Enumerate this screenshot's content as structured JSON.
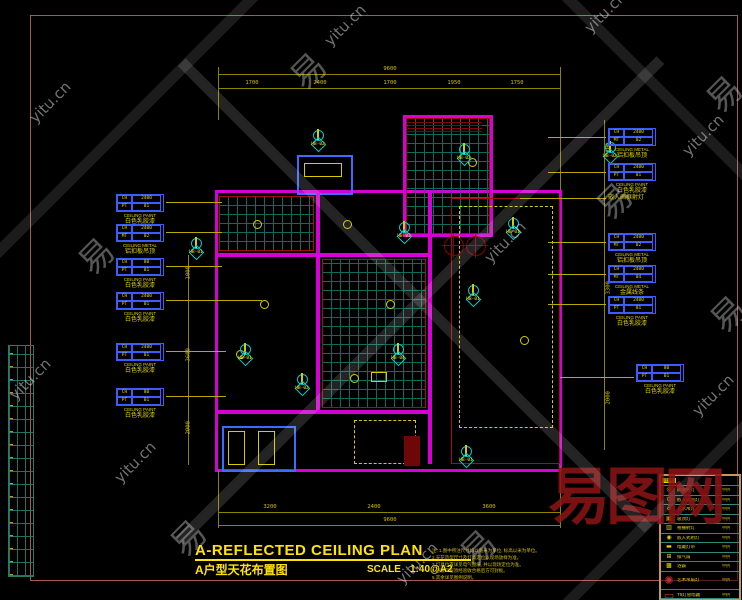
{
  "colors": {
    "yellow": "#d8cc00",
    "magenta": "#d400d4",
    "cyan": "#00cccc",
    "teal_grid": "#107060",
    "red": "#a01010",
    "frame": "#a85858",
    "blue": "#3c6cff",
    "logo_red": "#8a1416"
  },
  "watermarks": {
    "site": "yitu.cn",
    "char": "易",
    "logo": "易图网"
  },
  "titlebar": {
    "title_en": "A-REFLECTED CEILING PLAN",
    "title_cn": "A户型天花布置图",
    "scale_label": "SCALE",
    "scale_value": "1:40@A2"
  },
  "notes": {
    "heading": "注:",
    "lines": [
      "1.图中所注尺寸均以毫米为单位, 标高以米为单位。",
      "2.天花造型尺寸及灯具定位以现场放样为准。",
      "3.灯具位置详见电气图纸, 并以现场定位为准。",
      "4.隐蔽工程须经验收合格后方可封板。",
      "5.其余详见图例说明。"
    ]
  },
  "dimensions": {
    "top": {
      "overall": "9600",
      "segments": [
        "1700",
        "2400",
        "1700",
        "1950",
        "1750"
      ]
    },
    "bottom": {
      "overall": "9600",
      "segments": [
        "3200",
        "2400",
        "3600"
      ]
    },
    "left": [
      "1000",
      "3600",
      "2000"
    ],
    "right": [
      "600",
      "3300",
      "2000"
    ]
  },
  "materials": {
    "left": [
      {
        "f1": "CH",
        "v1": "2400",
        "f2": "PT",
        "v2": "01",
        "en": "CEILING PAINT",
        "cn": "白色乳胶漆"
      },
      {
        "f1": "CH",
        "v1": "2400",
        "f2": "MT",
        "v2": "02",
        "en": "CEILING METAL",
        "cn": "铝扣板吊顶"
      },
      {
        "f1": "CH",
        "v1": "80",
        "f2": "PT",
        "v2": "01",
        "en": "CEILING PAINT",
        "cn": "白色乳胶漆"
      },
      {
        "f1": "CH",
        "v1": "2400",
        "f2": "PT",
        "v2": "01",
        "en": "CEILING PAINT",
        "cn": "白色乳胶漆"
      },
      {
        "f1": "CH",
        "v1": "2400",
        "f2": "PT",
        "v2": "01",
        "en": "CEILING PAINT",
        "cn": "白色乳胶漆"
      },
      {
        "f1": "CH",
        "v1": "80",
        "f2": "PT",
        "v2": "01",
        "en": "CEILING PAINT",
        "cn": "白色乳胶漆"
      }
    ],
    "right": [
      {
        "f1": "CH",
        "v1": "2400",
        "f2": "MT",
        "v2": "02",
        "en": "CEILING METAL",
        "cn": "铝扣板吊顶"
      },
      {
        "f1": "CH",
        "v1": "2400",
        "f2": "PT",
        "v2": "01",
        "en": "CEILING PAINT",
        "cn": "白色乳胶漆"
      },
      {
        "f1": "CH",
        "v1": "2400",
        "f2": "MT",
        "v2": "02",
        "en": "CEILING METAL",
        "cn": "铝扣板吊顶"
      },
      {
        "f1": "CH",
        "v1": "2400",
        "f2": "MT",
        "v2": "04",
        "en": "CEILING METAL",
        "cn": "金属线条"
      },
      {
        "f1": "CH",
        "v1": "2400",
        "f2": "PT",
        "v2": "01",
        "en": "CEILING PAINT",
        "cn": "白色乳胶漆"
      },
      {
        "f1": "CH",
        "v1": "80",
        "f2": "PT",
        "v2": "01",
        "en": "CEILING PAINT",
        "cn": "白色乳胶漆"
      }
    ],
    "right_note": "嵌入画框射灯"
  },
  "callouts": [
    {
      "code": "HB-02"
    },
    {
      "code": "HB-02"
    },
    {
      "code": "HB-02"
    },
    {
      "code": "HB-01"
    },
    {
      "code": "HB-03"
    },
    {
      "code": "HB-01"
    },
    {
      "code": "HB-01"
    },
    {
      "code": "HB-04"
    },
    {
      "code": "HB-02"
    },
    {
      "code": "HB-01"
    },
    {
      "code": "HB-01"
    }
  ],
  "legend": {
    "header": "图例",
    "rows": [
      {
        "sym": "◎",
        "name": "防雾筒灯",
        "remark": "甲供"
      },
      {
        "sym": "⊙",
        "name": "嵌入式筒灯",
        "remark": "甲供"
      },
      {
        "sym": "♁",
        "name": "艺术吊灯",
        "remark": "甲供"
      },
      {
        "sym": "▣",
        "name": "吸顶灯",
        "remark": "甲供"
      },
      {
        "sym": "▥",
        "name": "格栅射灯",
        "remark": "甲供"
      },
      {
        "sym": "◉",
        "name": "嵌入式射灯",
        "remark": "甲供"
      },
      {
        "sym": "▬",
        "name": "暗藏灯带",
        "remark": "甲供"
      },
      {
        "sym": "⊞",
        "name": "排气扇",
        "remark": "甲供"
      },
      {
        "sym": "▩",
        "name": "浴霸",
        "remark": "甲供"
      },
      {
        "sym": "✺",
        "name": "艺术吊扇灯",
        "remark": "甲供"
      },
      {
        "sym": "▭",
        "name": "T5灯管暗藏",
        "remark": "甲供"
      }
    ]
  }
}
